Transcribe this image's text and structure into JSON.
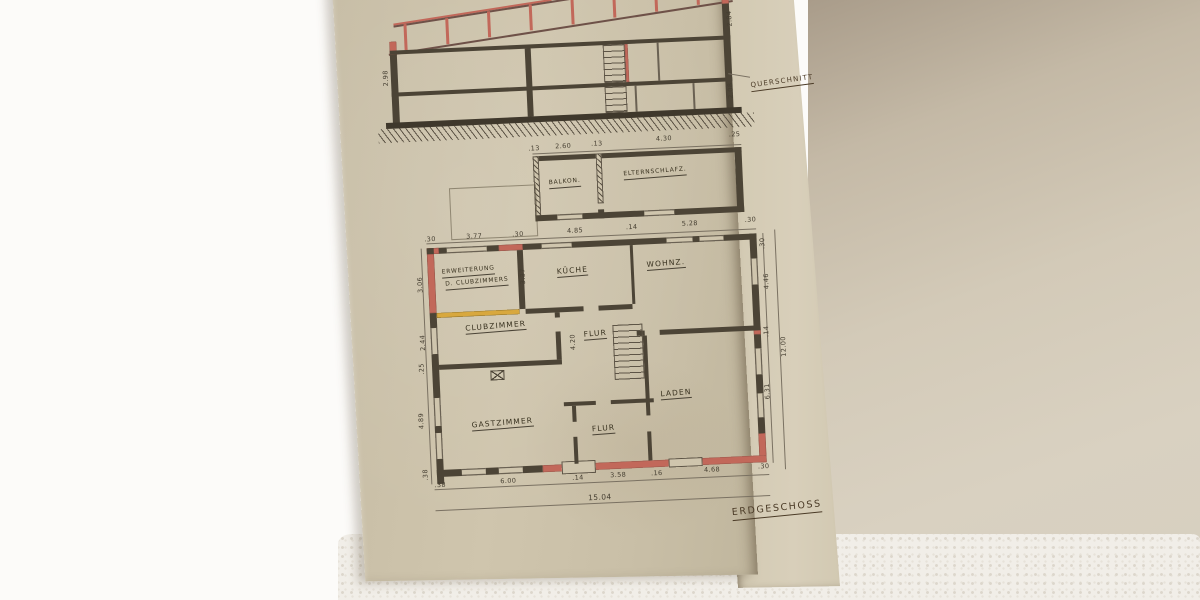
{
  "photo": {
    "description": "hand-drawn architectural plan sheet on white floor",
    "colors": {
      "paper": "#cbc1a9",
      "ink": "#4c4436",
      "new_wall_red": "#c2685a",
      "demolition_yellow": "#d8a83e",
      "background": "#fcfbf9",
      "carpet": "#f1eee8"
    }
  },
  "section": {
    "title": "QUERSCHNITT",
    "dim_right_top": "2.84",
    "dim_right_bottom": "2.08",
    "dim_left": "2.98"
  },
  "upper_plan": {
    "rooms": {
      "balkon": "BALKON.",
      "elternschlafz": "ELTERNSCHLAFZ."
    },
    "dims": [
      ".13",
      "2.60",
      ".13",
      "4.30",
      ".25"
    ]
  },
  "ground_plan": {
    "title": "ERDGESCHOSS",
    "rooms": {
      "erweiterung_line1": "ERWEITERUNG",
      "erweiterung_line2": "D. CLUBZIMMERS",
      "kueche": "KÜCHE",
      "wohnz": "WOHNZ.",
      "clubzimmer": "CLUBZIMMER",
      "flur_mitte": "FLUR",
      "laden": "LADEN",
      "gastzimmer": "GASTZIMMER",
      "flur_unten": "FLUR"
    },
    "dims_top": [
      ".30",
      "3.77",
      ".30",
      "4.85",
      ".14",
      "5.28",
      ".30"
    ],
    "dims_bottom": [
      ".38",
      "6.00",
      ".14",
      "3.58",
      ".16",
      "4.68",
      ".30"
    ],
    "dims_left": [
      "3.06",
      "2.44",
      ".25",
      "4.89",
      ".38"
    ],
    "dims_right": [
      ".30",
      "4.46",
      ".14",
      "6.31"
    ],
    "kueche_depth": "3.37",
    "flur_length": "4.20",
    "total_width": "15.04",
    "total_height": "12.00"
  }
}
